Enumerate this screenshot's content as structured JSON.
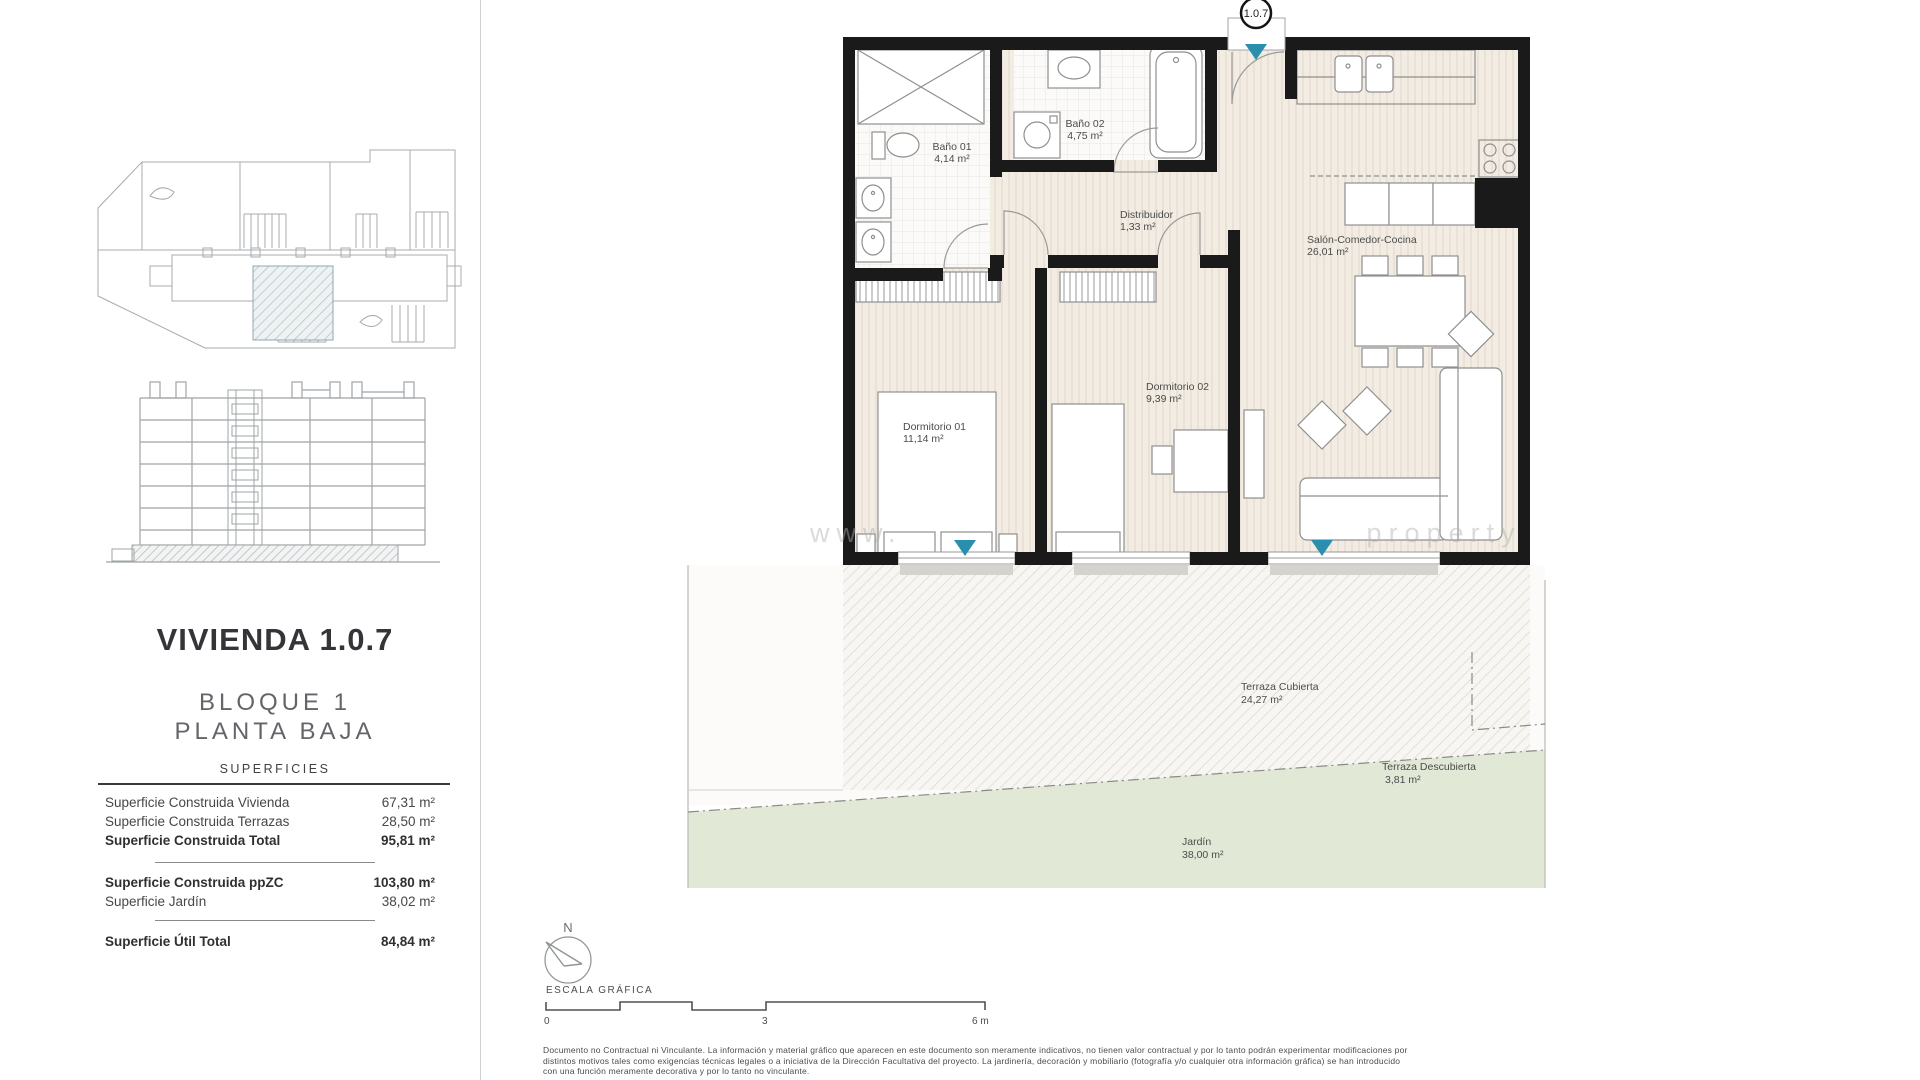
{
  "document": {
    "type": "floor-plan-sheet",
    "colors": {
      "accent_teal": "#2a8fad",
      "wall_black": "#1a1a1a",
      "floor_beige": "#f2ebe2",
      "garden_green": "#e2e8d6",
      "hatch_gray": "#dcd8d0",
      "drawing_gray": "#9fa4a7"
    }
  },
  "left_panel": {
    "title": "VIVIENDA 1.0.7",
    "subtitle_line1": "BLOQUE 1",
    "subtitle_line2": "PLANTA BAJA",
    "table_header": "SUPERFICIES",
    "rows": [
      {
        "label": "Superficie Construida Vivienda",
        "value": "67,31 m²"
      },
      {
        "label": "Superficie Construida Terrazas",
        "value": "28,50 m²"
      },
      {
        "label": "Superficie Construida Total",
        "value": "95,81 m²"
      },
      {
        "label": "Superficie Construida ppZC",
        "value": "103,80 m²"
      },
      {
        "label": "Superficie Jardín",
        "value": "38,02 m²"
      },
      {
        "label": "Superficie Útil Total",
        "value": "84,84 m²"
      }
    ]
  },
  "plan": {
    "unit_badge": "1.0.7",
    "rooms": [
      {
        "name": "Baño 01",
        "area": "4,14 m²"
      },
      {
        "name": "Baño 02",
        "area": "4,75 m²"
      },
      {
        "name": "Distribuidor",
        "area": "1,33 m²"
      },
      {
        "name": "Salón-Comedor-Cocina",
        "area": "26,01 m²"
      },
      {
        "name": "Dormitorio 01",
        "area": "11,14 m²"
      },
      {
        "name": "Dormitorio 02",
        "area": "9,39 m²"
      },
      {
        "name": "Terraza Cubierta",
        "area": "24,27 m²"
      },
      {
        "name": "Terraza Descubierta",
        "area": "3,81 m²"
      },
      {
        "name": "Jardín",
        "area": "38,00 m²"
      }
    ],
    "watermark": "www.                                property"
  },
  "scale_bar": {
    "north_label": "N",
    "caption": "ESCALA GRÁFICA",
    "ticks": [
      "0",
      "3",
      "6 m"
    ]
  },
  "disclaimer": {
    "line1": "Documento no Contractual ni Vinculante. La información y material gráfico que aparecen en este documento son meramente indicativos, no tienen valor contractual y por lo tanto podrán experimentar modificaciones por",
    "line2": "distintos motivos tales como exigencias técnicas legales o a iniciativa de la Dirección Facultativa del proyecto. La jardinería, decoración y mobiliario (fotografía y/o cualquier otra información gráfica) se han introducido",
    "line3": "con una función meramente decorativa y por lo tanto no vinculante."
  }
}
